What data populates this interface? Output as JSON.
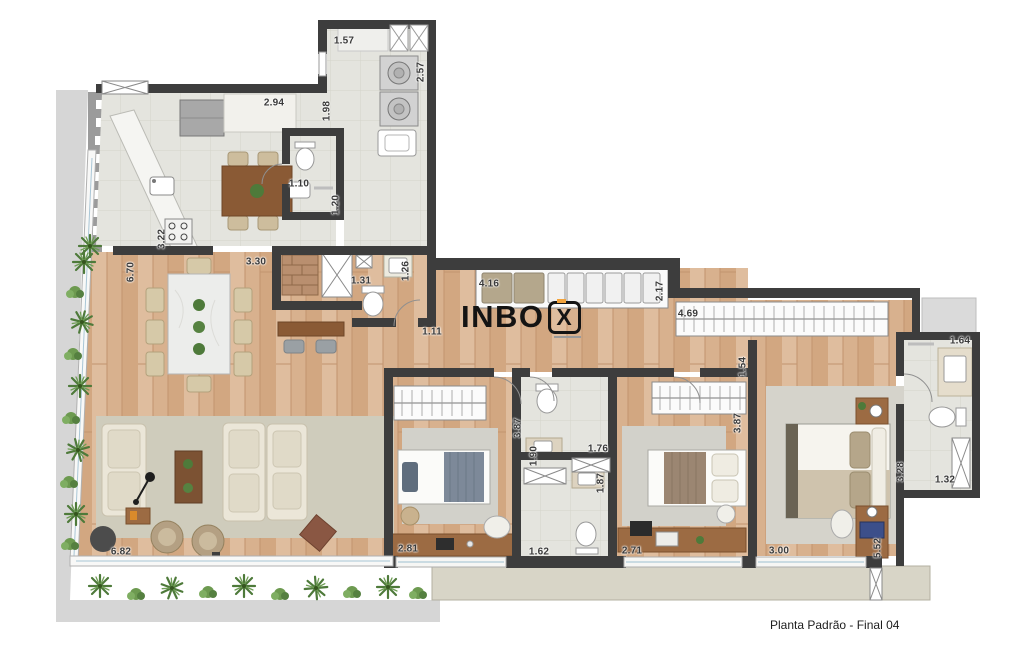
{
  "floorplan": {
    "caption": "Planta Padrão - Final 04",
    "logo": {
      "main": "INBO",
      "boxed": "X"
    },
    "colors": {
      "accent": "#f2a33c",
      "wall": "#3d3d3d",
      "wood_floor": "#d8b18e",
      "tile_floor": "#e4e4de",
      "terrace": "#d8d5c7",
      "rug": "#cfccbc",
      "plant": "#4e7a3a"
    },
    "dimensions": [
      {
        "value": "1.57",
        "x": 344,
        "y": 41,
        "rot": 0
      },
      {
        "value": "2.57",
        "x": 421,
        "y": 72,
        "rot": -90
      },
      {
        "value": "2.94",
        "x": 274,
        "y": 103,
        "rot": 0
      },
      {
        "value": "1.98",
        "x": 327,
        "y": 111,
        "rot": -90
      },
      {
        "value": "1.10",
        "x": 299,
        "y": 184,
        "rot": 0
      },
      {
        "value": "1.20",
        "x": 336,
        "y": 205,
        "rot": -90
      },
      {
        "value": "3.22",
        "x": 162,
        "y": 239,
        "rot": -90
      },
      {
        "value": "6.70",
        "x": 131,
        "y": 272,
        "rot": -90
      },
      {
        "value": "3.30",
        "x": 256,
        "y": 262,
        "rot": 0
      },
      {
        "value": "1.31",
        "x": 361,
        "y": 281,
        "rot": 0
      },
      {
        "value": "1.26",
        "x": 406,
        "y": 271,
        "rot": -90
      },
      {
        "value": "1.11",
        "x": 432,
        "y": 332,
        "rot": 0
      },
      {
        "value": "4.16",
        "x": 489,
        "y": 284,
        "rot": 0
      },
      {
        "value": "2.17",
        "x": 660,
        "y": 291,
        "rot": -90
      },
      {
        "value": "4.69",
        "x": 688,
        "y": 314,
        "rot": 0
      },
      {
        "value": "1.54",
        "x": 743,
        "y": 367,
        "rot": -90
      },
      {
        "value": "1.64",
        "x": 960,
        "y": 341,
        "rot": 0
      },
      {
        "value": "3.87",
        "x": 518,
        "y": 428,
        "rot": -90
      },
      {
        "value": "1.90",
        "x": 534,
        "y": 456,
        "rot": -90
      },
      {
        "value": "1.76",
        "x": 598,
        "y": 449,
        "rot": 0
      },
      {
        "value": "1.87",
        "x": 601,
        "y": 483,
        "rot": -90
      },
      {
        "value": "1.62",
        "x": 539,
        "y": 552,
        "rot": 0
      },
      {
        "value": "2.81",
        "x": 408,
        "y": 549,
        "rot": 0
      },
      {
        "value": "2.71",
        "x": 632,
        "y": 551,
        "rot": 0
      },
      {
        "value": "3.87",
        "x": 738,
        "y": 423,
        "rot": -90
      },
      {
        "value": "3.00",
        "x": 779,
        "y": 551,
        "rot": 0
      },
      {
        "value": "5.52",
        "x": 878,
        "y": 548,
        "rot": -90
      },
      {
        "value": "3.28",
        "x": 901,
        "y": 472,
        "rot": -90
      },
      {
        "value": "1.32",
        "x": 945,
        "y": 480,
        "rot": 0
      },
      {
        "value": "6.82",
        "x": 121,
        "y": 552,
        "rot": 0
      }
    ]
  }
}
